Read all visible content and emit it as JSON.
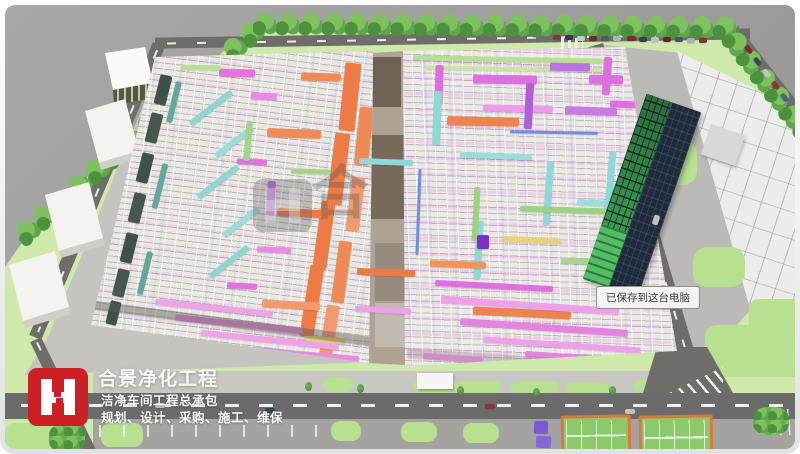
{
  "watermark": {
    "character": "合"
  },
  "toast": {
    "text": "已保存到这台电脑"
  },
  "brand": {
    "title": "合景净化工程",
    "subtitle": "洁净车间工程总承包",
    "services": "规划、设计、采购、施工、维保"
  },
  "palette": {
    "brand_red": "#cb2026",
    "background_gray": "#9c9c9c",
    "lawn_green": "#cfe9ab",
    "patch_green": "#b7e191",
    "tree_green": "#5ea74a",
    "road_gray": "#6f6d6a",
    "hall_roof_gray": "#eae7e4",
    "pipe_orange": "#ee7b46",
    "pipe_magenta": "#df6fdf",
    "pipe_pink": "#efa0e8",
    "pipe_cyan": "#8fd8d6",
    "pipe_green": "#9fd184",
    "pipe_yellow": "#e6d47c",
    "tower_navy": "#1f2b3a",
    "tower_glass_green": "#2f8f44",
    "court_green": "#8cc96a",
    "court_border_orange": "#e0763c",
    "toast_bg": "#f4f3f1"
  }
}
